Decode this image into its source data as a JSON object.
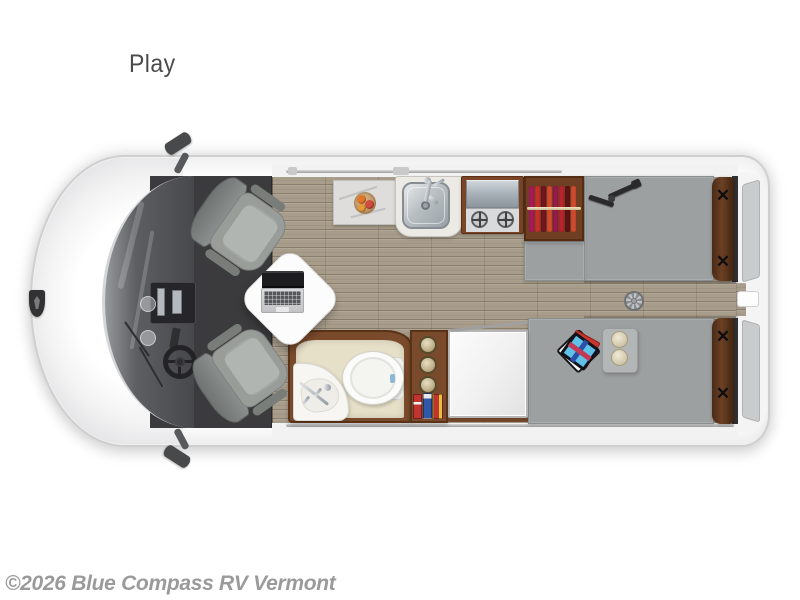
{
  "labels": {
    "model": "Play",
    "watermark": "©2026 Blue Compass RV Vermont"
  },
  "floorplan": {
    "type": "class-b-camper-van-top-view",
    "orientation": "front-left-rear-right",
    "areas": {
      "cab": {
        "features": [
          "hood-badge",
          "windshield",
          "dashboard-console",
          "steering-wheel",
          "side-mirror-top",
          "side-mirror-bottom",
          "swivel-seat-driver",
          "swivel-seat-passenger",
          "pedestal-table",
          "laptop"
        ]
      },
      "galley": {
        "features": [
          "marble-countertop",
          "fruit-bowl",
          "stainless-sink",
          "faucet",
          "two-burner-cooktop",
          "hanging-wardrobe"
        ]
      },
      "bathroom": {
        "features": [
          "toilet",
          "corner-sink",
          "storage-shelf",
          "canisters",
          "pantry-boxes"
        ]
      },
      "bedroom": {
        "features": [
          "twin-bed-front",
          "twin-bed-rear",
          "center-aisle",
          "roof-fan",
          "serving-tray-with-plates",
          "board-game",
          "bolster-pillows",
          "rear-doors"
        ]
      },
      "appliances": [
        "refrigerator"
      ]
    },
    "colors": {
      "background": "#ffffff",
      "van_body": "#ffffff",
      "cab_floor": "#3b3b3d",
      "wood_floor": "#a89d8b",
      "mattress": "#9da0a1",
      "cabinet_wood": "#794a2b",
      "bathroom_floor": "#e7e0c9",
      "bolster_pillow": "#5a3a22",
      "clothes": [
        "#a6195b",
        "#c42f28",
        "#731420",
        "#d04b2b",
        "#951a4e",
        "#b8232c",
        "#5f1113",
        "#ce4a2e"
      ],
      "watermark_text": "#9a9a9a"
    },
    "glyphs": {
      "pillow_tie": "✕"
    }
  }
}
